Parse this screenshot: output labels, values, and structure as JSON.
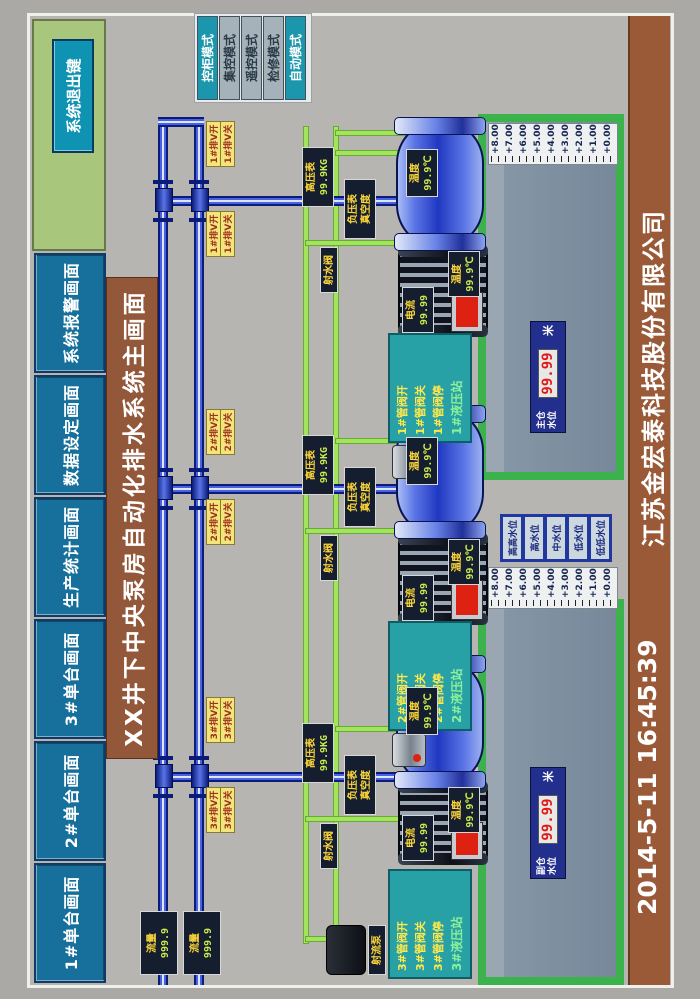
{
  "nav": {
    "buttons": [
      {
        "label": "1#单台画面"
      },
      {
        "label": "2#单台画面"
      },
      {
        "label": "3#单台画面"
      },
      {
        "label": "生产统计画面"
      },
      {
        "label": "数据设定画面"
      },
      {
        "label": "系统报警画面"
      }
    ],
    "exit_label": "系统退出键"
  },
  "title": "XX井下中央泵房自动化排水系统主画面",
  "mode_panel": {
    "buttons": [
      {
        "label": "控柜模式",
        "active": true
      },
      {
        "label": "集控模式",
        "active": false
      },
      {
        "label": "遥控模式",
        "active": false
      },
      {
        "label": "检修模式",
        "active": false
      },
      {
        "label": "自动模式",
        "active": true
      }
    ]
  },
  "pipelines": {
    "flow_meters": [
      {
        "label": "流量",
        "value": "999.9"
      },
      {
        "label": "流量",
        "value": "999.9"
      }
    ]
  },
  "units": [
    {
      "id": "1#",
      "pump_temp_label": "温度",
      "pump_temp_value": "99.9℃",
      "motor_current_label": "电流",
      "motor_current_value": "99.99",
      "motor_temp_label": "温度",
      "motor_temp_value": "99.9℃",
      "valve_open": "1#排V开",
      "valve_close": "1#排V关",
      "gauge_high_label": "高压表",
      "gauge_high_value": "99.9KG",
      "gauge_vac_label": "负压表",
      "gauge_vac_value": "真空度",
      "jet_valve_label": "射水阀",
      "hydraulic": {
        "title": "1#液压站",
        "rows": [
          "1#管阀开",
          "1#管阀关",
          "1#管阀停"
        ]
      }
    },
    {
      "id": "2#",
      "pump_temp_label": "温度",
      "pump_temp_value": "99.9℃",
      "motor_current_label": "电流",
      "motor_current_value": "99.99",
      "motor_temp_label": "温度",
      "motor_temp_value": "99.9℃",
      "valve_open": "2#排V开",
      "valve_close": "2#排V关",
      "gauge_high_label": "高压表",
      "gauge_high_value": "99.9KG",
      "gauge_vac_label": "负压表",
      "gauge_vac_value": "真空度",
      "jet_valve_label": "射水阀",
      "hydraulic": {
        "title": "2#液压站",
        "rows": [
          "2#管阀开",
          "2#管阀关",
          "2#管阀停"
        ]
      }
    },
    {
      "id": "3#",
      "pump_temp_label": "温度",
      "pump_temp_value": "99.9℃",
      "motor_current_label": "电流",
      "motor_current_value": "99.99",
      "motor_temp_label": "温度",
      "motor_temp_value": "99.9℃",
      "valve_open": "3#排V开",
      "valve_close": "3#排V关",
      "gauge_high_label": "高压表",
      "gauge_high_value": "99.9KG",
      "gauge_vac_label": "负压表",
      "gauge_vac_value": "真空度",
      "jet_valve_label": "射水阀",
      "hydraulic": {
        "title": "3#液压站",
        "rows": [
          "3#管阀开",
          "3#管阀关",
          "3#管阀停"
        ]
      }
    }
  ],
  "sumps": [
    {
      "name": "主仓",
      "level_label": "水位",
      "level_value": "99.99",
      "unit": "米"
    },
    {
      "name": "副仓",
      "level_label": "水位",
      "level_value": "99.99",
      "unit": "米"
    }
  ],
  "scale_labels": [
    "+8.00",
    "+7.00",
    "+6.00",
    "+5.00",
    "+4.00",
    "+3.00",
    "+2.00",
    "+1.00",
    "+0.00"
  ],
  "level_buttons": [
    {
      "label": "高高水位"
    },
    {
      "label": "高水位"
    },
    {
      "label": "中水位"
    },
    {
      "label": "低水位"
    },
    {
      "label": "低低水位"
    }
  ],
  "devices": {
    "jet_pump_label": "射流泵"
  },
  "footer": {
    "datetime": "2014-5-11  16:45:39",
    "company": "江苏金宏泰科技股份有限公司"
  },
  "colors": {
    "nav_teal": "#17709b",
    "panel_green": "#a9c77c",
    "banner_brown": "#93583a",
    "pipe_blue": "#2644cc",
    "line_green": "#a2e45c",
    "suction_pink": "#d9a0e8",
    "alarm_red": "#dd2211",
    "water": "#8a98a8",
    "sump_green": "#3cb24c"
  }
}
